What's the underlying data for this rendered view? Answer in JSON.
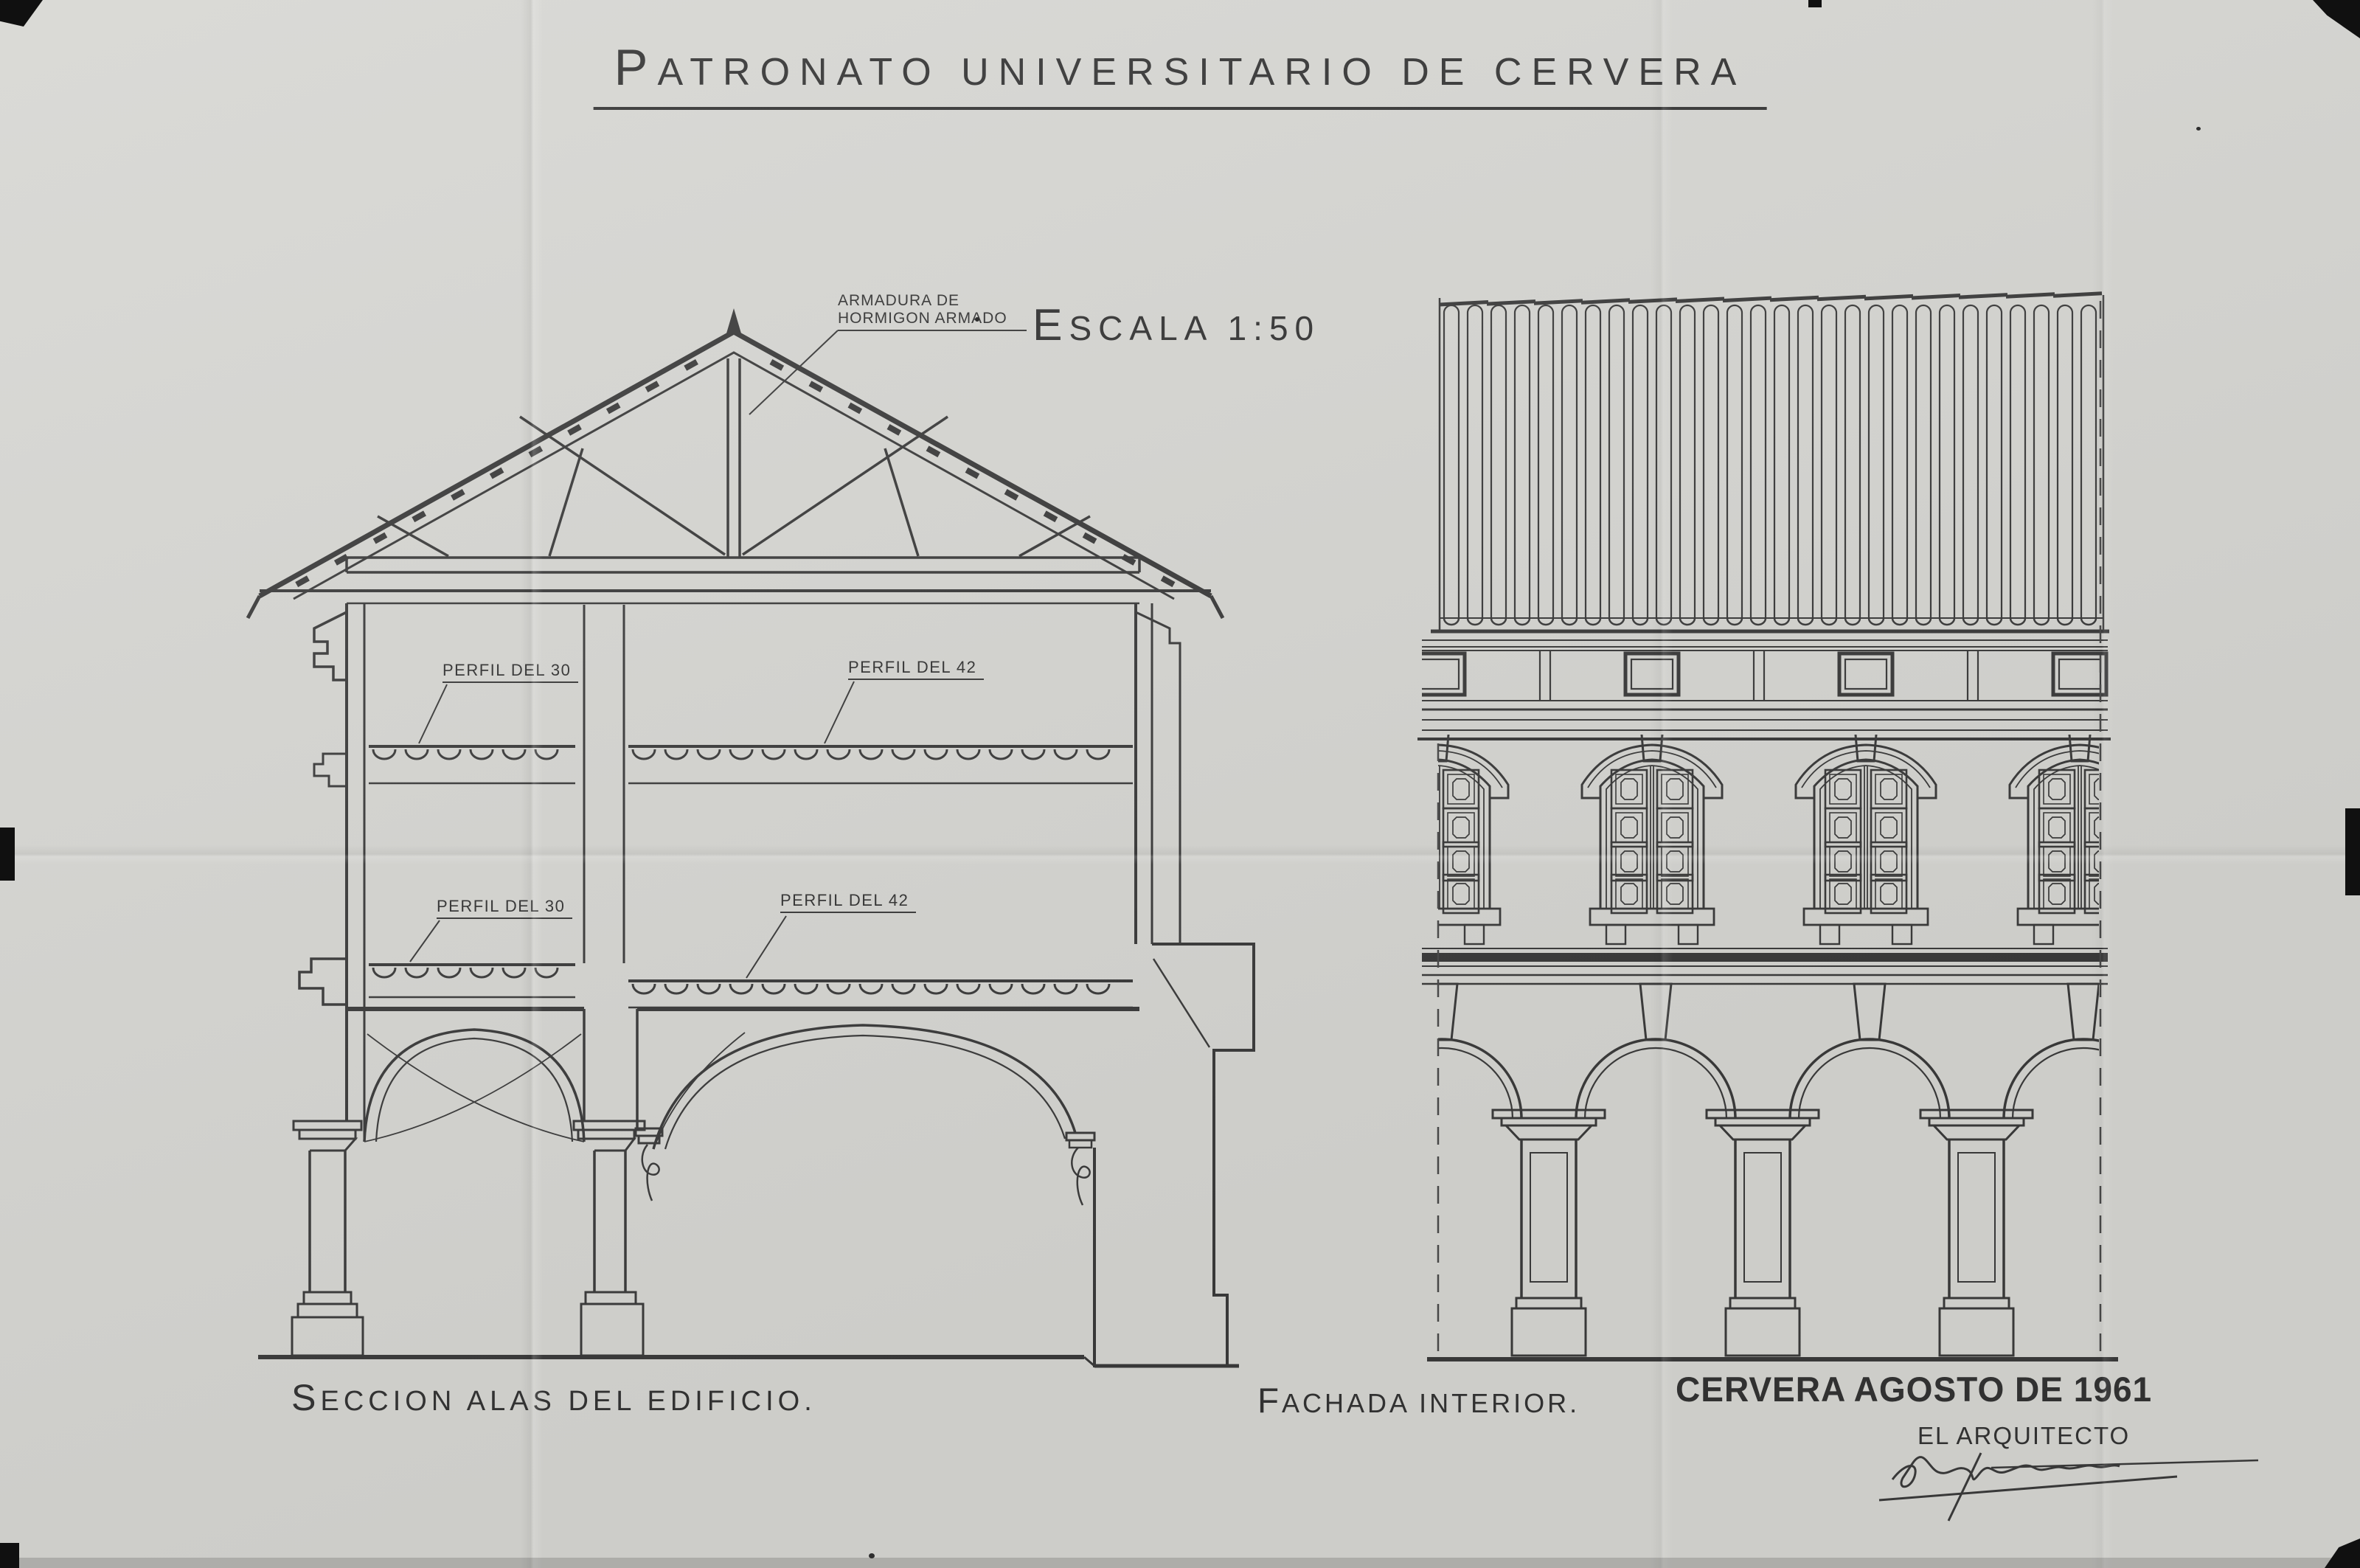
{
  "sheet": {
    "title": "PATRONATO UNIVERSITARIO DE CERVERA",
    "scale_label": "ESCALA 1:50"
  },
  "section_view": {
    "caption": "SECCION ALAS DEL EDIFICIO.",
    "labels": {
      "truss": "ARMADURA DE\nHORMIGON ARMADO",
      "upper_floor_left": "PERFIL DEL 30",
      "upper_floor_right": "PERFIL DEL 42",
      "lower_floor_left": "PERFIL DEL 30",
      "lower_floor_right": "PERFIL DEL 42"
    }
  },
  "facade_view": {
    "caption": "FACHADA INTERIOR."
  },
  "title_block": {
    "place_date": "CERVERA AGOSTO DE 1961",
    "architect_label": "EL ARQUITECTO"
  },
  "colors": {
    "paper": "#d6d6d2",
    "ink": "#3a3a3a"
  }
}
